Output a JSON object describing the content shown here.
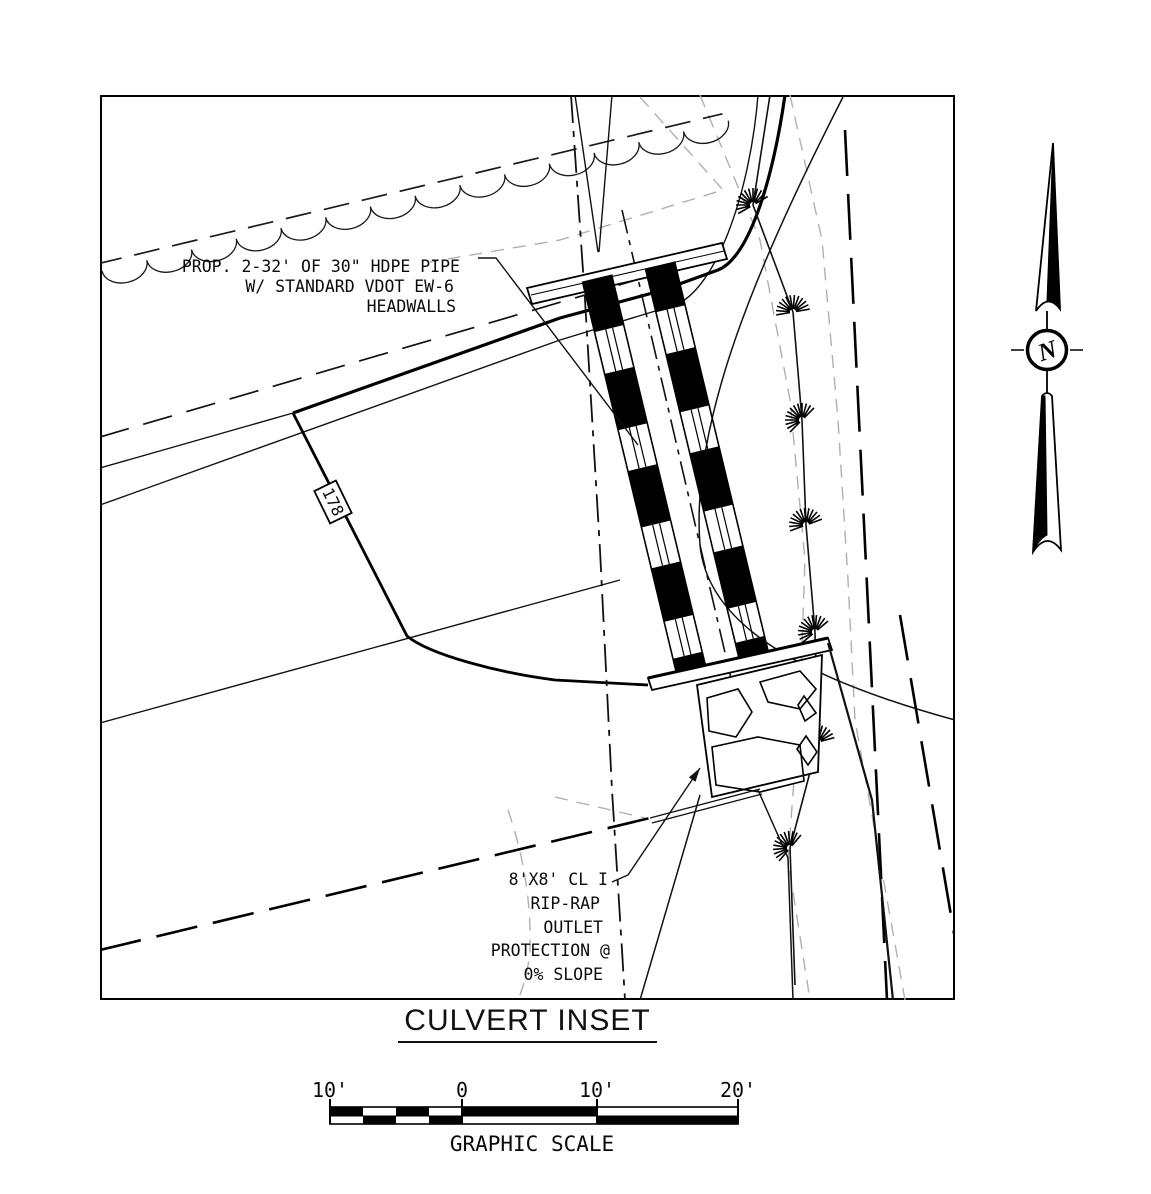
{
  "title": "CULVERT INSET",
  "labels": {
    "pipe": [
      "PROP. 2-32' OF 30\" HDPE PIPE",
      "W/ STANDARD VDOT EW-6",
      "HEADWALLS"
    ],
    "riprap": [
      "8'X8' CL I",
      "RIP-RAP",
      "OUTLET",
      "PROTECTION @",
      "0% SLOPE"
    ],
    "contour": "178"
  },
  "north_arrow": {
    "letter": "N"
  },
  "scale_bar": {
    "ticks": [
      "10'",
      "0",
      "10'",
      "20'"
    ],
    "caption": "GRAPHIC SCALE"
  },
  "colors": {
    "ink": "#000000",
    "faint_gray": "#b0b0b0",
    "paper": "#ffffff"
  }
}
